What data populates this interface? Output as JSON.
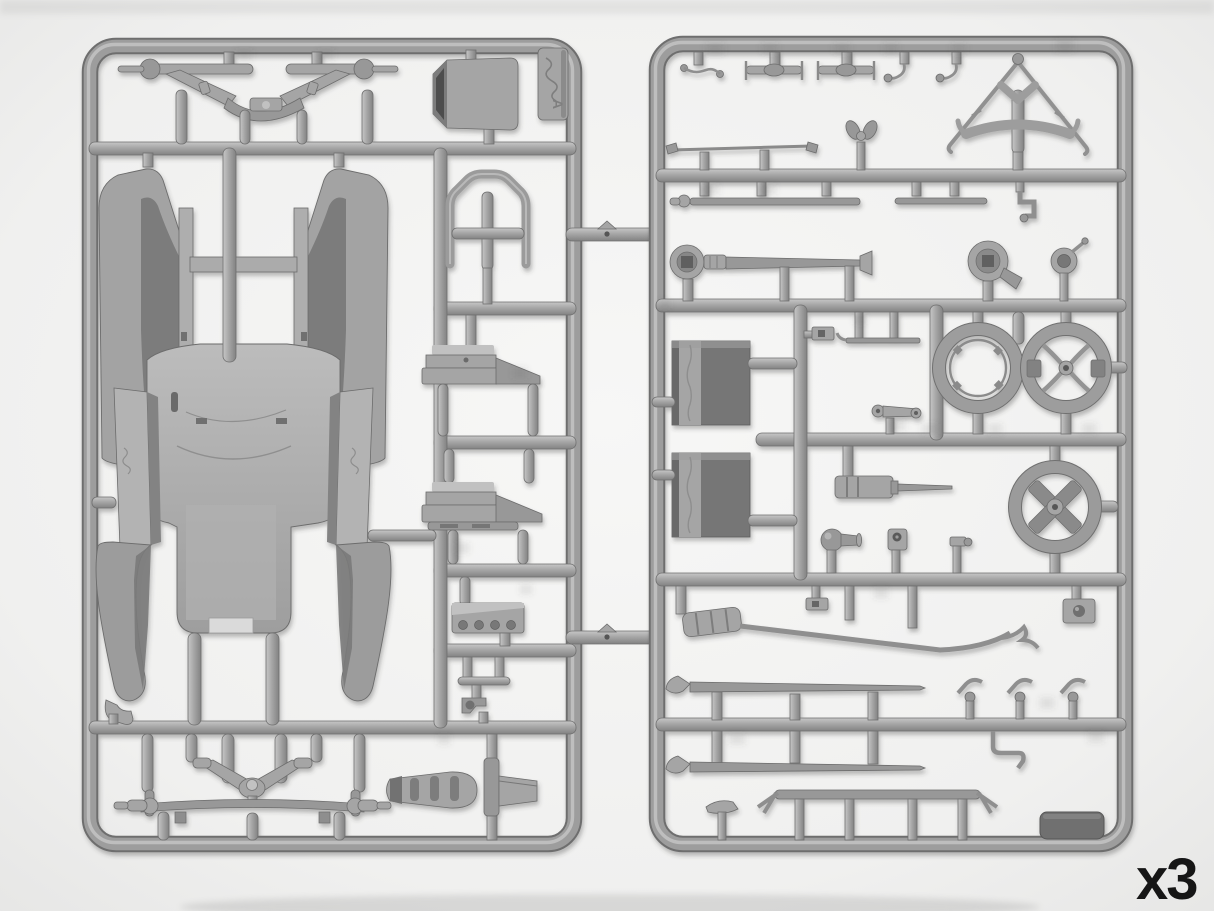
{
  "photo": {
    "subject": "Two grey injection-moulded model-kit sprues (vintage car parts) photographed on a white background",
    "quantity_label": "x3",
    "sprue_letter": "A"
  },
  "colors": {
    "background": "#f2f2f1",
    "plastic_highlight": "#c7c7c7",
    "plastic_mid": "#a5a5a5",
    "plastic_shadow": "#828282",
    "plastic_dark_detail": "#767676",
    "outline": "#6c6c6c",
    "label_text": "#161616"
  },
  "sprues": {
    "left": {
      "parts": [
        "rear-axle-assembly",
        "firewall-plate",
        "sprue-letter-tag",
        "body-floor-with-fenders",
        "windshield-frame",
        "seat-base-front",
        "seat-base-rear",
        "engine-block",
        "pedal-bracket",
        "front-axle-assembly",
        "muffler-with-bracket",
        "corner-hook"
      ]
    },
    "right": {
      "parts": [
        "control-lever",
        "linkage-rod-1",
        "linkage-rod-2",
        "hook-lever-1",
        "hook-lever-2",
        "tie-rod",
        "wing-nut",
        "top-bow-frame",
        "hand-crank",
        "long-rod",
        "short-rod",
        "steering-column",
        "horn",
        "magneto-coil",
        "seat-cushion-front",
        "seat-cushion-rear",
        "clip-bracket",
        "thin-link",
        "hand-lever",
        "wheel-rim",
        "steering-wheel",
        "grease-cylinder",
        "bulb-horn",
        "bracket-with-hole",
        "small-fitting",
        "cross-spoke-wheel",
        "exhaust-pipe-with-muffler",
        "junction-box",
        "fender-iron-rod-1",
        "fender-iron-rod-2",
        "lamp-bracket-1",
        "lamp-bracket-2",
        "lamp-bracket-3",
        "elbow-pipe",
        "running-board-bar",
        "saddle-bracket",
        "battery-box"
      ]
    }
  }
}
